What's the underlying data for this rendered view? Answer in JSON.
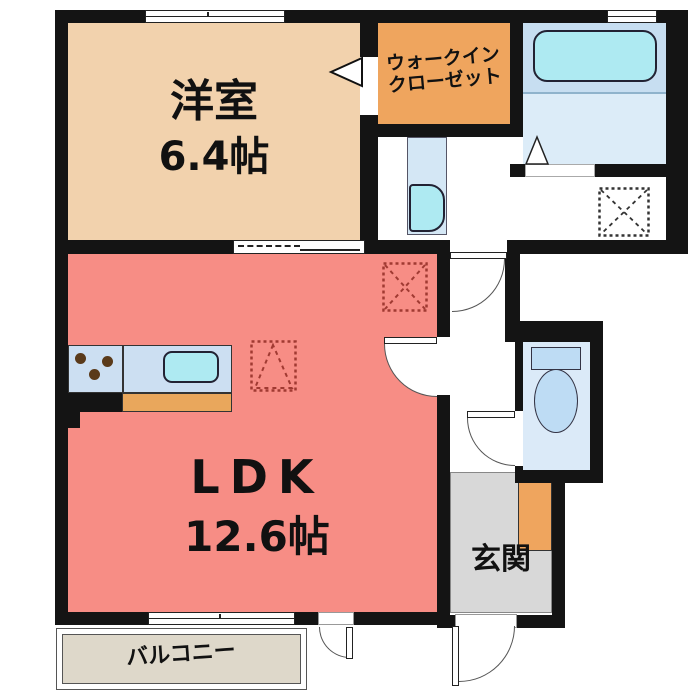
{
  "rooms": {
    "yoshitsu": {
      "name": "洋室",
      "size": "6.4帖"
    },
    "walk_in_closet": {
      "line1": "ウォークイン",
      "line2": "クローゼット"
    },
    "ldk": {
      "name": "LDK",
      "size": "12.6帖"
    },
    "genkan": {
      "name": "玄関"
    },
    "balcony": {
      "name": "バルコニー"
    }
  },
  "colors": {
    "yoshitsu": "#f2d2ad",
    "walk_in_closet": "#efa55e",
    "ldk": "#f78d85",
    "genkan": "#d8d8d8",
    "balcony": "#ded8ca",
    "bath_upper": "#c7def1",
    "bath_floor": "#dcecf8",
    "toilet_floor": "#dbeaf8",
    "fixture_blue": "#bedcf4",
    "water_cyan": "#aeeaf2",
    "counter_blue": "#ccdff2",
    "counter_orange": "#e9a75c",
    "shoebox_orange": "#efa55e",
    "wall": "#141414",
    "dashed_red": "#a03a32",
    "dashed_black": "#333333"
  },
  "fixtures": {
    "bathtub": "bathtub-icon",
    "toilet": "toilet-icon",
    "washbasin": "washbasin-icon",
    "kitchen_sink": "kitchen-sink-icon",
    "stove_burners": "stove-burners-icon",
    "washing_machine_space": "washing-machine-space-icon",
    "refrigerator_space": "refrigerator-space-icon",
    "cupboard_space": "cupboard-space-icon"
  }
}
